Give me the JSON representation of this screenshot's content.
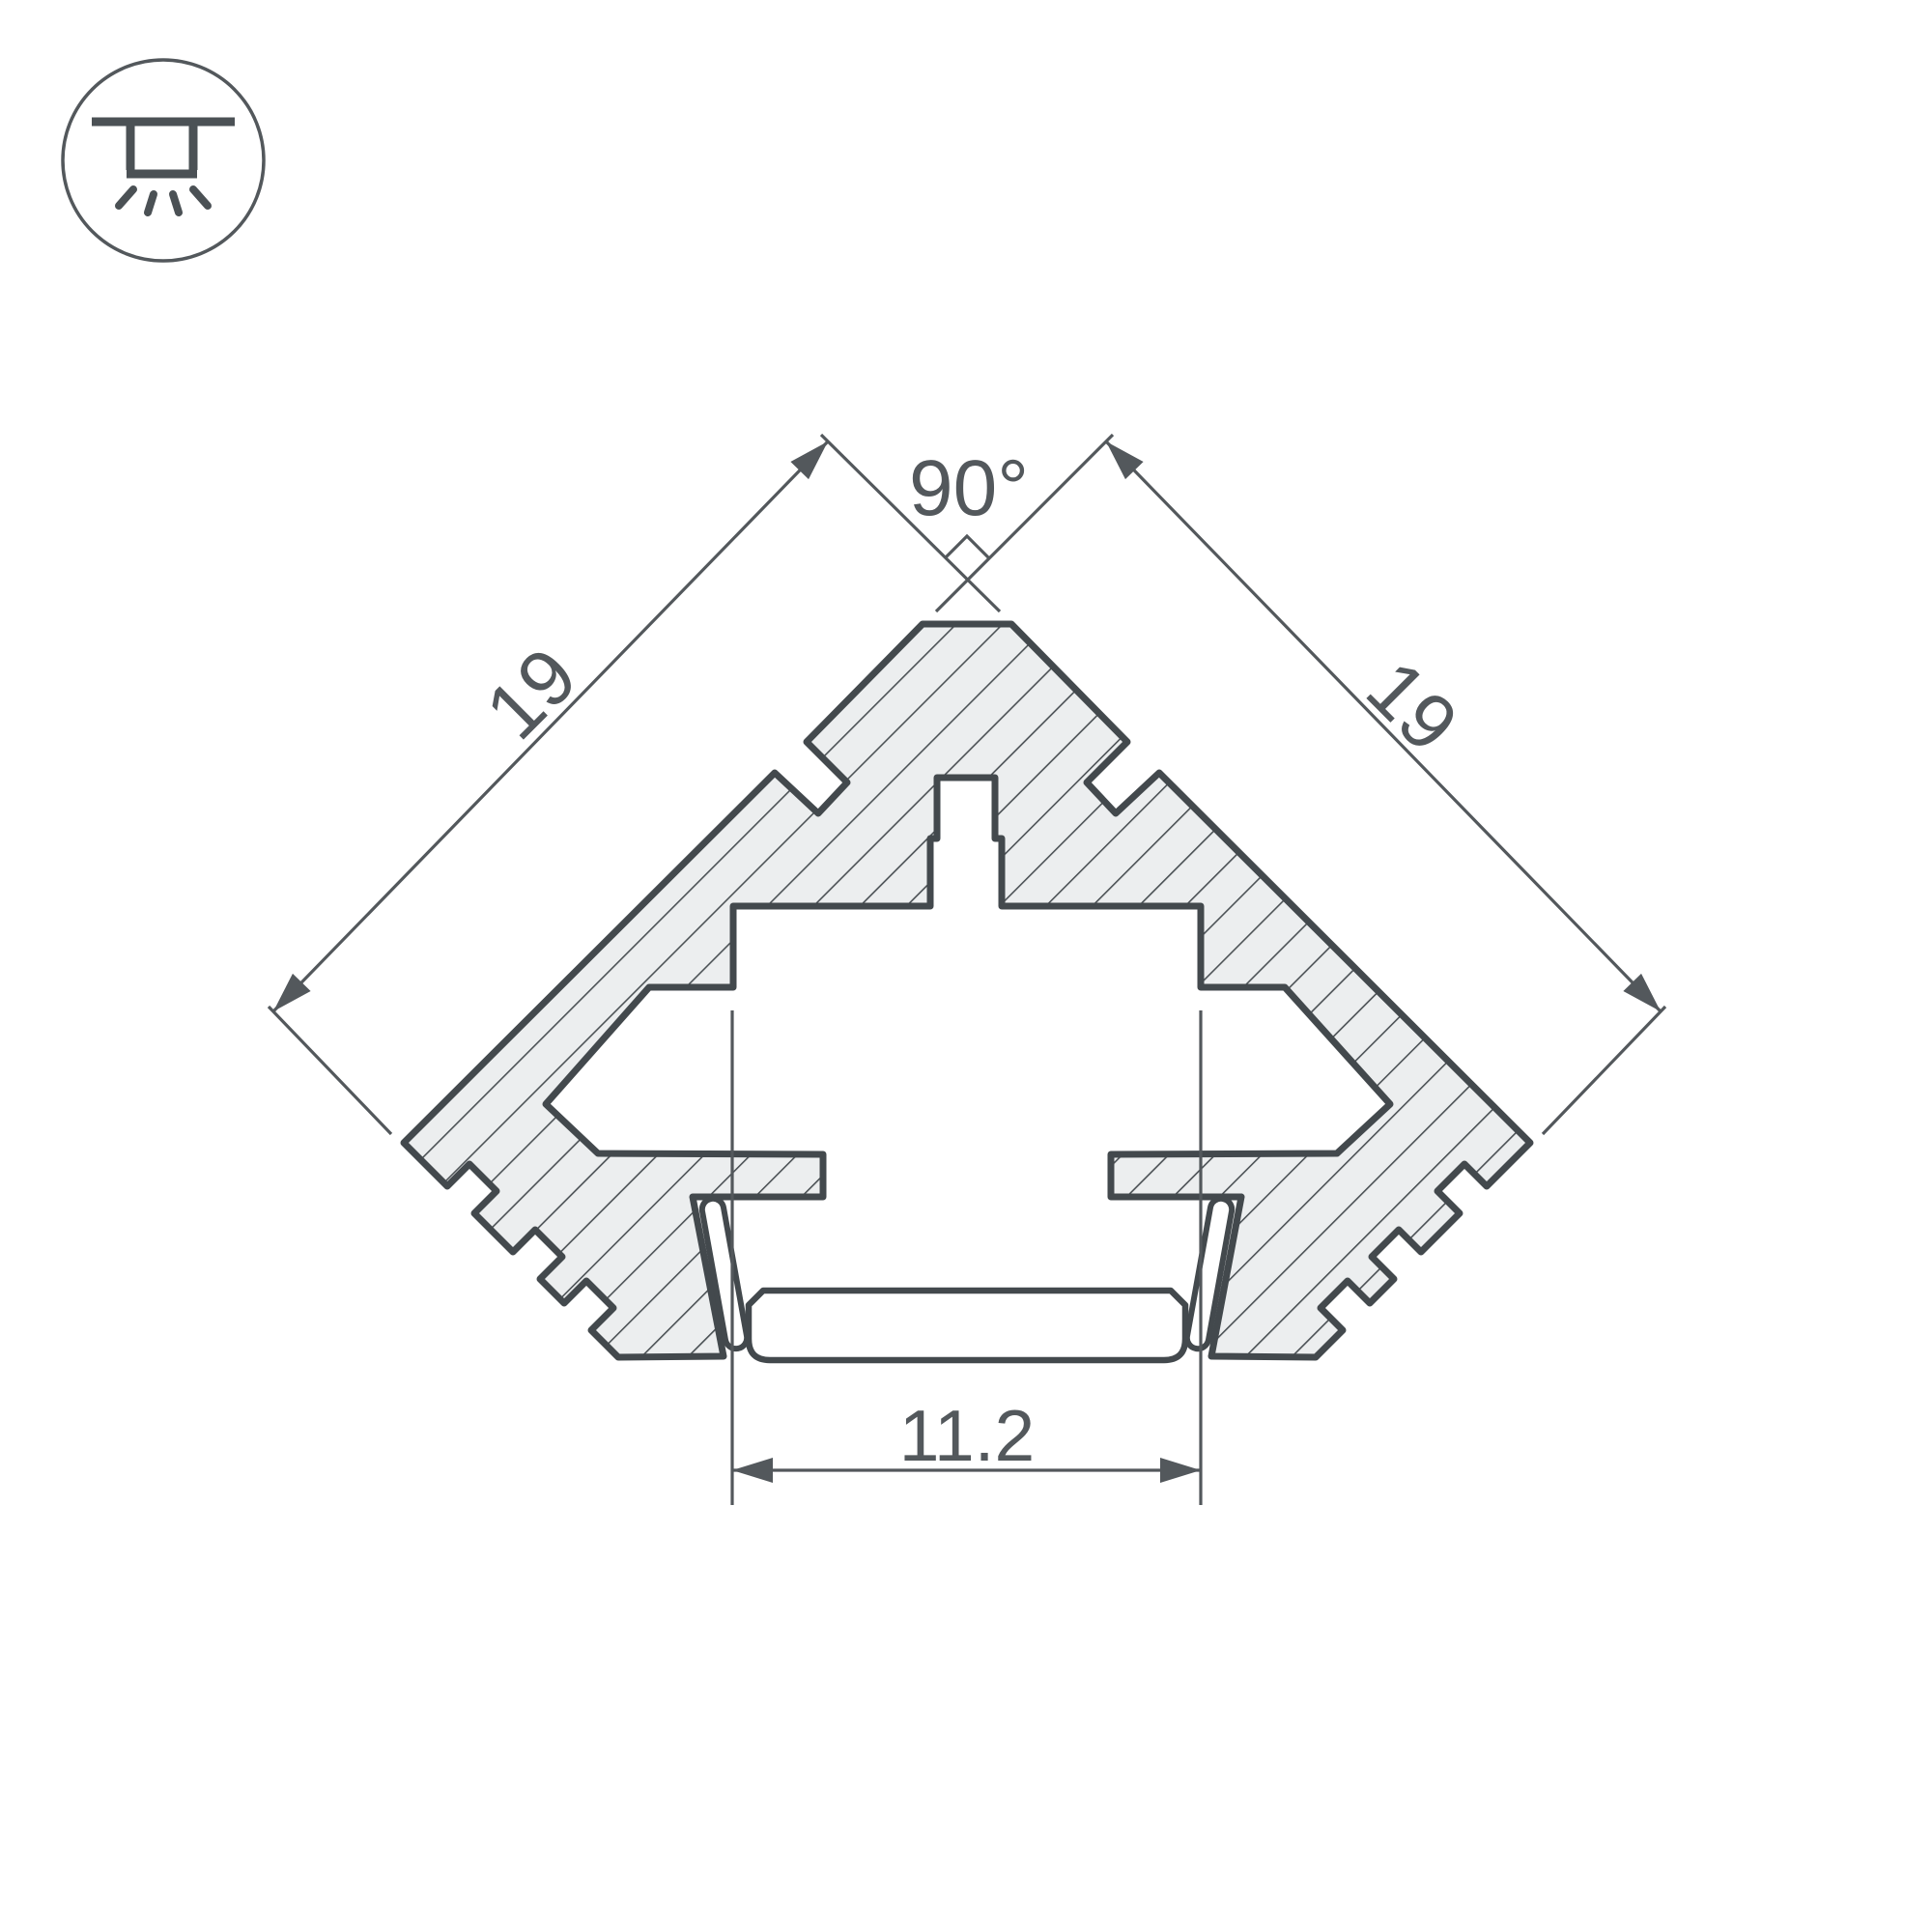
{
  "page": {
    "background": "#ffffff",
    "description": "technical cross-section drawing of a 90-degree corner LED profile"
  },
  "icon": {
    "name": "recessed-downlight-icon",
    "meaning": "recessed ceiling mounting"
  },
  "drawing": {
    "type": "technical-cross-section",
    "labels": {
      "angle_top": "90°",
      "edge_left": "19",
      "edge_right": "19",
      "channel_width": "11.2"
    },
    "colors": {
      "outline": "#43494D",
      "thin_lines": "#53585C",
      "aluminum_fill": "#ECEEEF",
      "hatch": "#4B5155",
      "background": "#FFFFFF"
    }
  }
}
